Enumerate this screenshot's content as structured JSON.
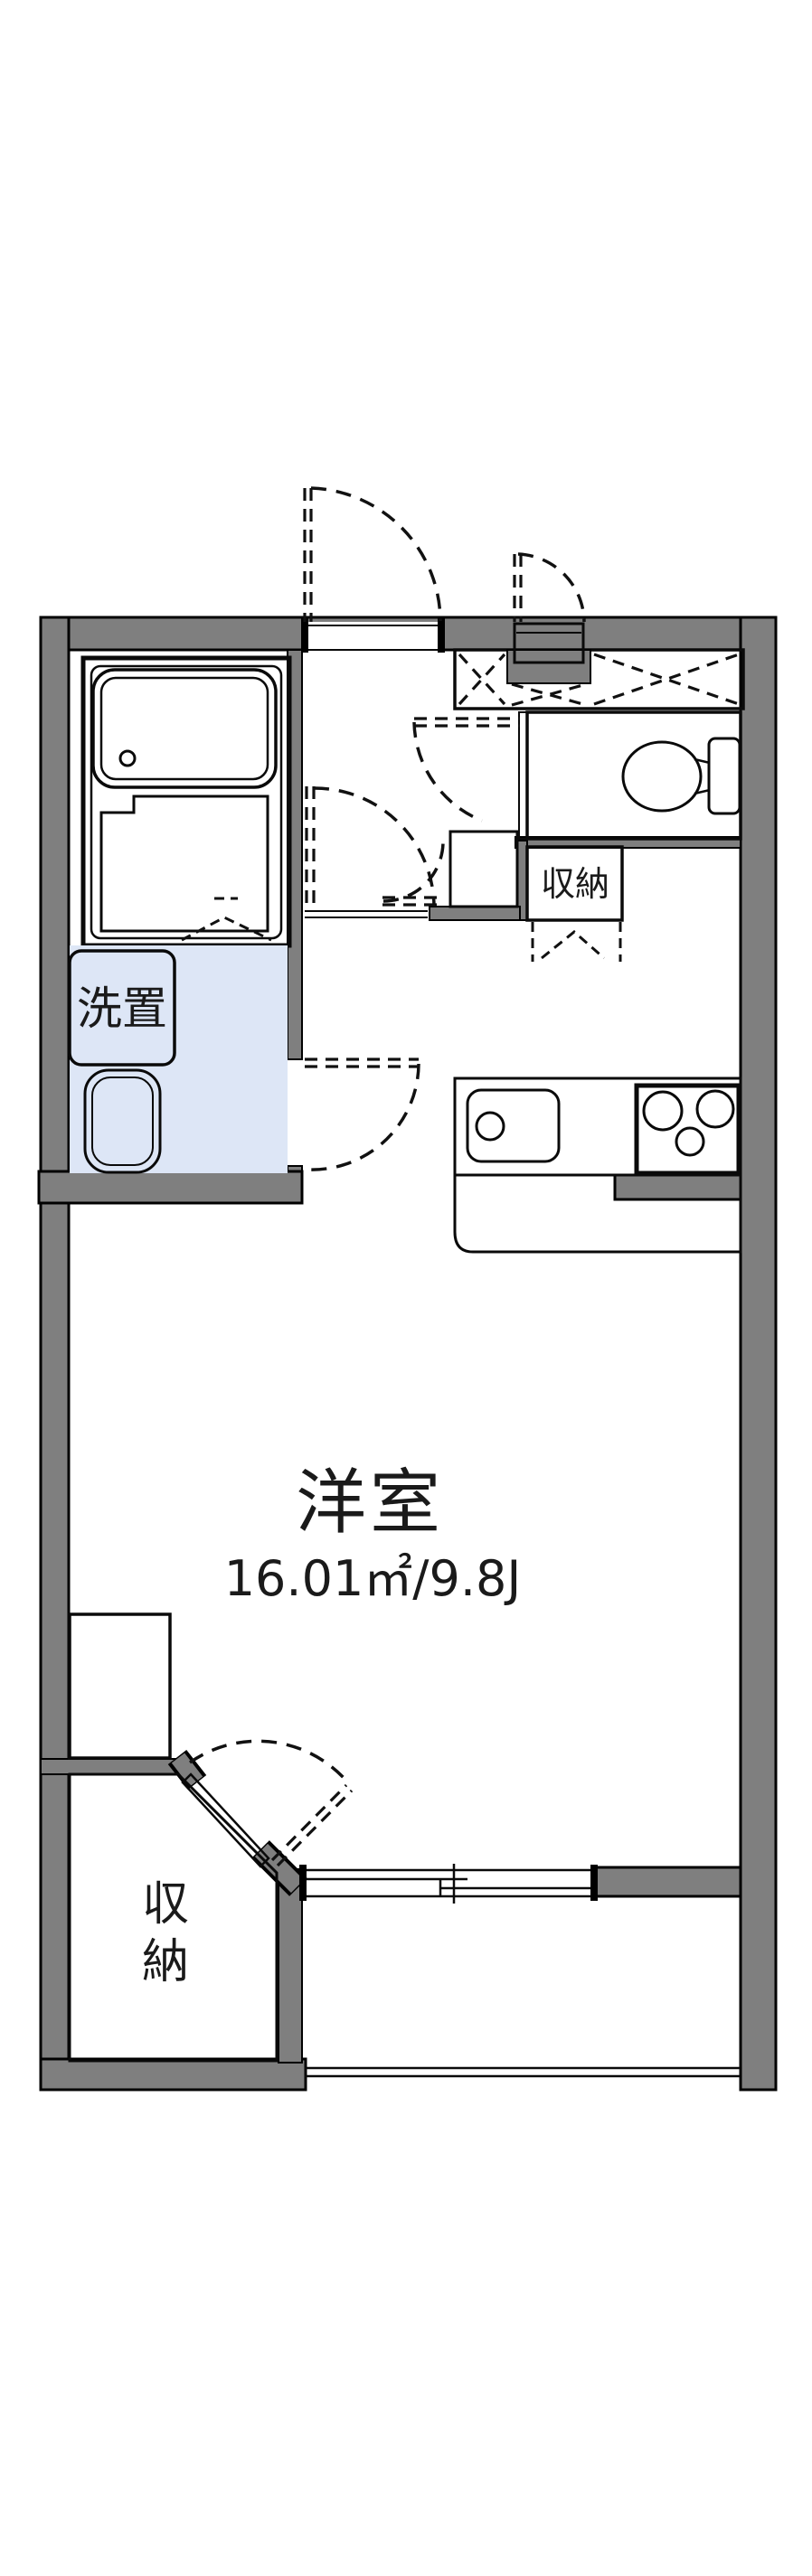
{
  "document": {
    "type": "apartment-floor-plan"
  },
  "colors": {
    "wall": "#7f7f7f",
    "fixture_blue": "#dde6f6",
    "storage_cream": "#f9edd2",
    "closet_cream": "#fcf3e2",
    "outline": "#0a0a0a"
  },
  "labels": {
    "washer_space": "洗置",
    "storage": "収納",
    "closet_chars": [
      "収",
      "納"
    ],
    "main_room": "洋室",
    "main_room_area": "16.01㎡/9.8J"
  }
}
